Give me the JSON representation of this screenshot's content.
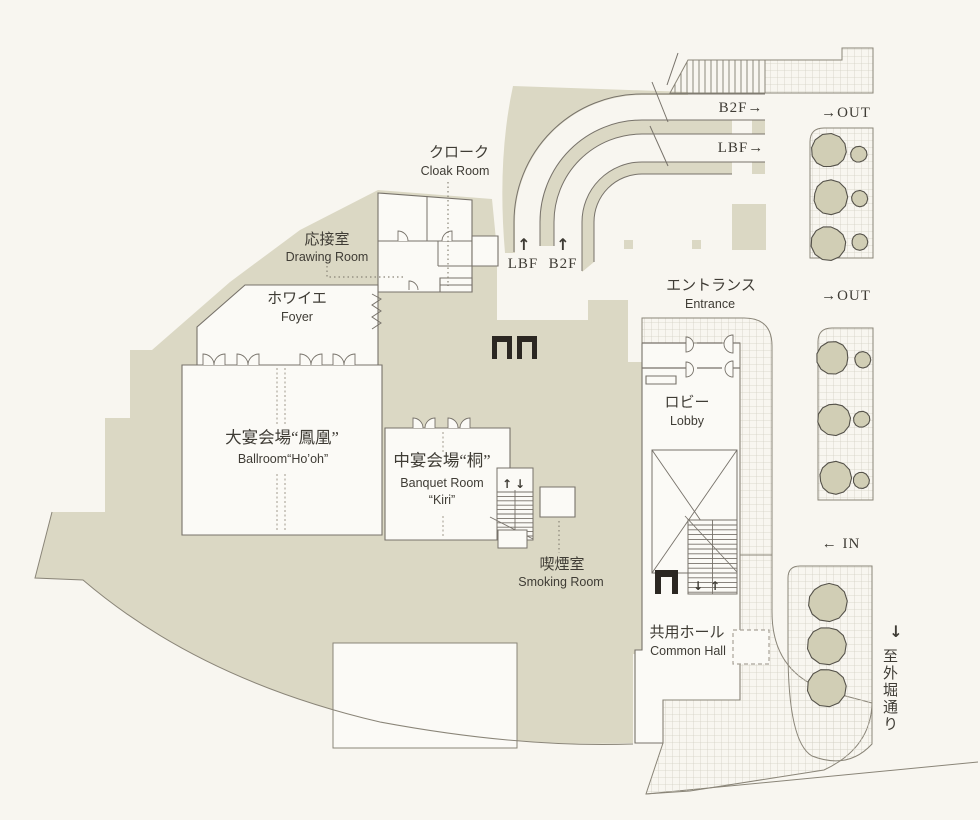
{
  "title": "banquet-floor-level-floorplan",
  "colors": {
    "background": "#f8f6f0",
    "beige": "#dbd8c4",
    "room_white": "#fbfaf6",
    "outline": "#77726a",
    "soft_line": "#8a8578",
    "hatch_line": "#d2cfc3",
    "stripe_line": "#8d897d",
    "tree_fill": "#d1ceb5",
    "tree_line": "#55524a",
    "text": "#3f3c35",
    "black": "#2b2722"
  },
  "rooms": {
    "cloak": {
      "jp": "クローク",
      "en": "Cloak Room"
    },
    "drawing": {
      "jp": "応接室",
      "en": "Drawing Room"
    },
    "foyer": {
      "jp": "ホワイエ",
      "en": "Foyer"
    },
    "ballroom": {
      "jp": "大宴会場“鳳凰”",
      "en": "Ballroom“Ho’oh”"
    },
    "kiri": {
      "jp": "中宴会場“桐”",
      "en1": "Banquet Room",
      "en2": "“Kiri”"
    },
    "smoking": {
      "jp": "喫煙室",
      "en": "Smoking Room"
    },
    "entrance": {
      "jp": "エントランス",
      "en": "Entrance"
    },
    "lobby": {
      "jp": "ロビー",
      "en": "Lobby"
    },
    "common_hall": {
      "jp": "共用ホール",
      "en": "Common Hall"
    }
  },
  "signs": {
    "b2f_exit": "B2F→",
    "lbf_exit": "LBF→",
    "out_upper": "→OUT",
    "out_lower": "→OUT",
    "in": "← IN",
    "ramp_arrow_lbf": "↑",
    "ramp_arrow_b2f": "↑",
    "lbf_ramp": "LBF",
    "b2f_ramp": "B2F",
    "street_arrow": "↓",
    "street": "至外堀通り",
    "stair_up": "↑",
    "stair_down": "↓"
  }
}
